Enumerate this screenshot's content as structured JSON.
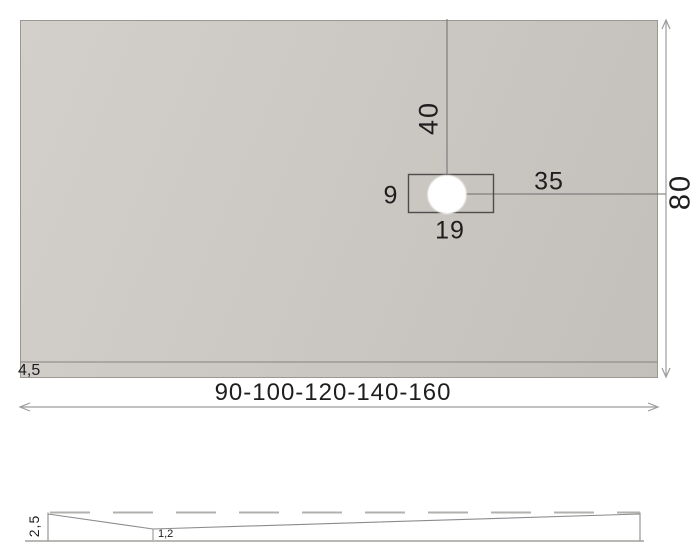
{
  "diagram_title": "shower-tray-dimension-drawing",
  "top_view": {
    "drain_distance_from_top": "40",
    "drain_distance_from_right": "35",
    "drain_cutout_height": "9",
    "drain_cutout_width": "19",
    "tray_depth": "80",
    "border_width": "4,5",
    "width_options": "90-100-120-140-160"
  },
  "side_view": {
    "edge_height": "2,5",
    "min_thickness": "1,2"
  },
  "colors": {
    "tray_fill_light": "#d3cfca",
    "tray_fill_dark": "#c3bfba",
    "tray_outline": "#9b9892",
    "drawing_line": "#6e6e6e",
    "dimension_line": "#9c9c9c",
    "profile_line": "#8c8c8c",
    "drain_hole_fill": "#ffffff",
    "text": "#1e1e1e",
    "background": "#ffffff"
  }
}
